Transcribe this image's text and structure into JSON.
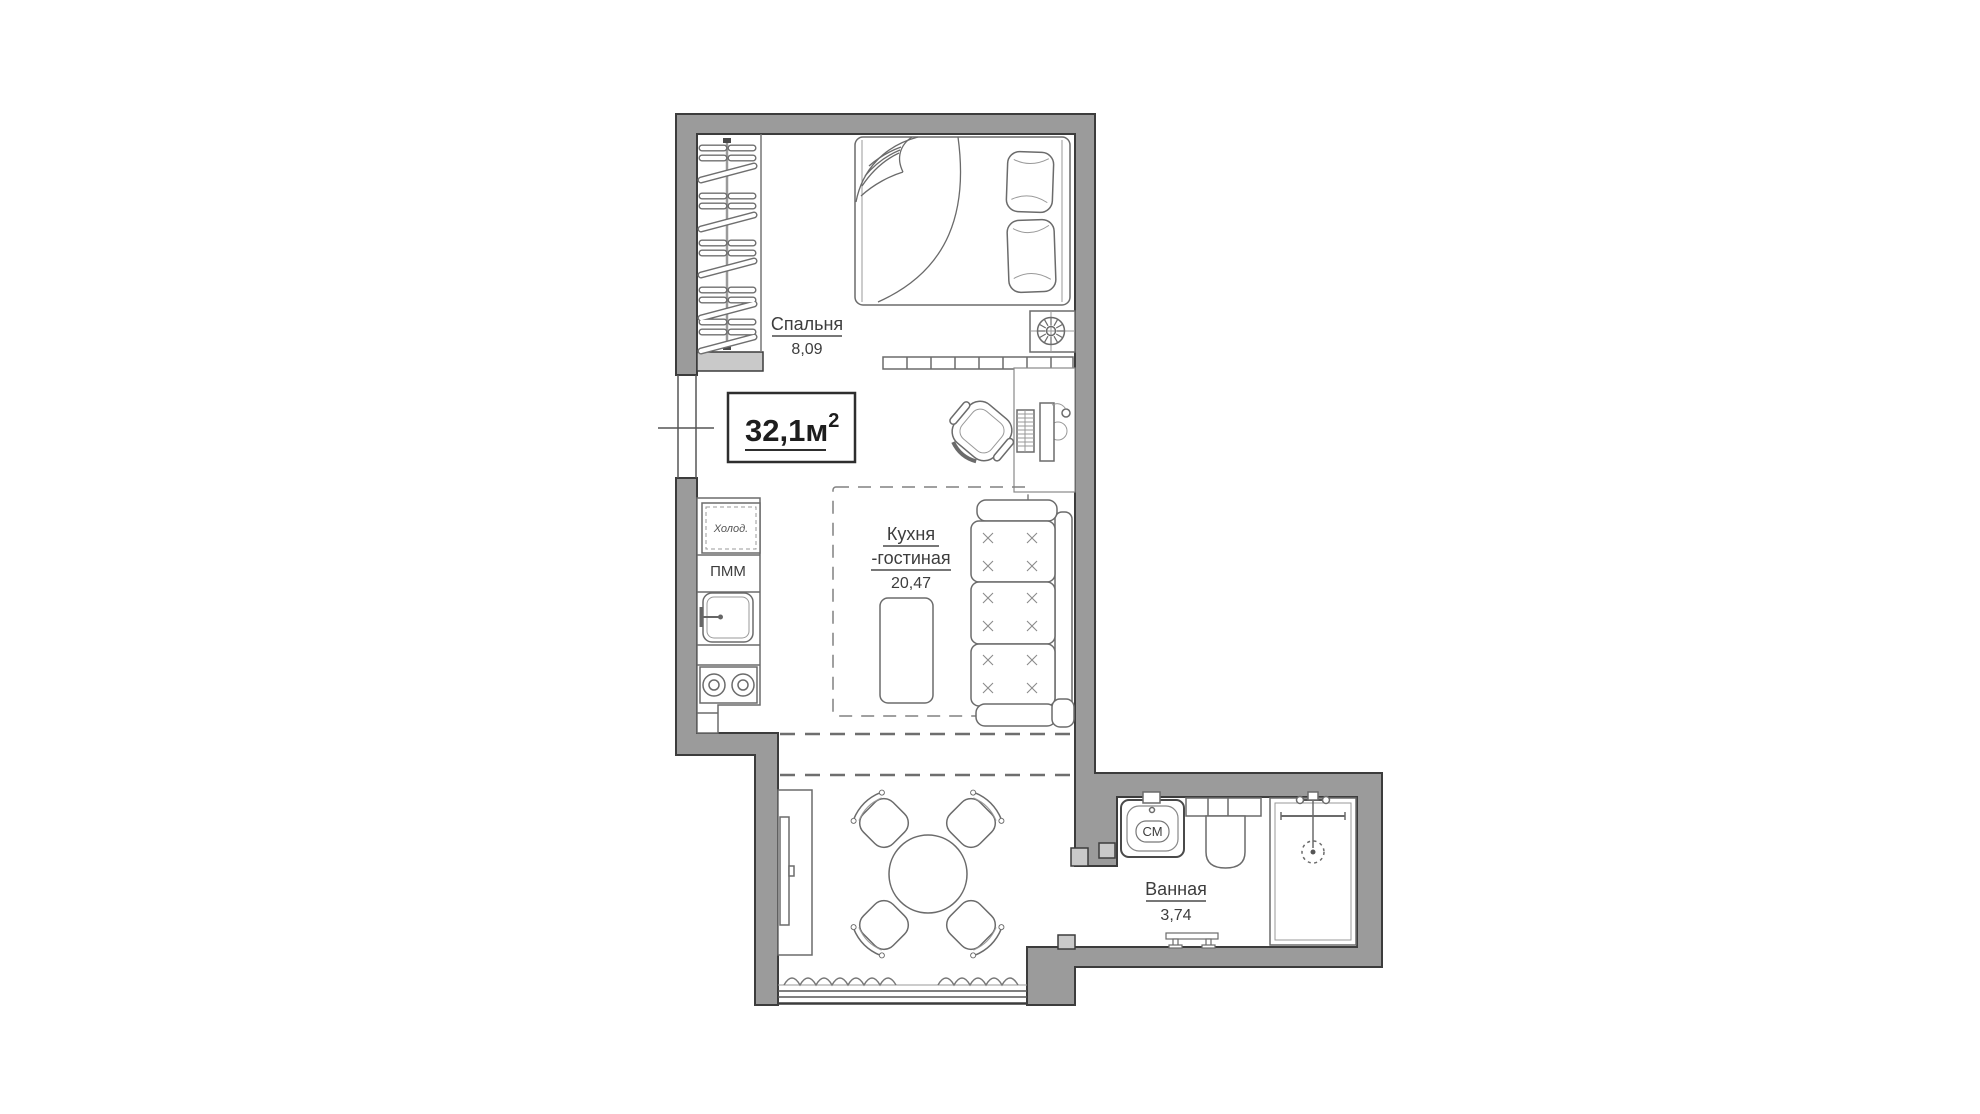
{
  "labels": {
    "total": {
      "main": "32,1м",
      "sup": "2"
    },
    "bedroom": {
      "name": "Спальня",
      "area": "8,09"
    },
    "kitchen_living": {
      "line1": "Кухня",
      "line2": "-гостиная",
      "area": "20,47"
    },
    "bathroom": {
      "name": "Ванная",
      "area": "3,74"
    },
    "fridge": "Холод.",
    "dishwasher": "ПММ",
    "washing_machine": "СМ"
  },
  "colors": {
    "wall": "#9b9b9b",
    "wall_outline": "#3c3c3c",
    "wall_light": "#c9c9c9",
    "furniture_line": "#6b6b6b",
    "text": "#3d3d3d",
    "background": "#ffffff"
  }
}
